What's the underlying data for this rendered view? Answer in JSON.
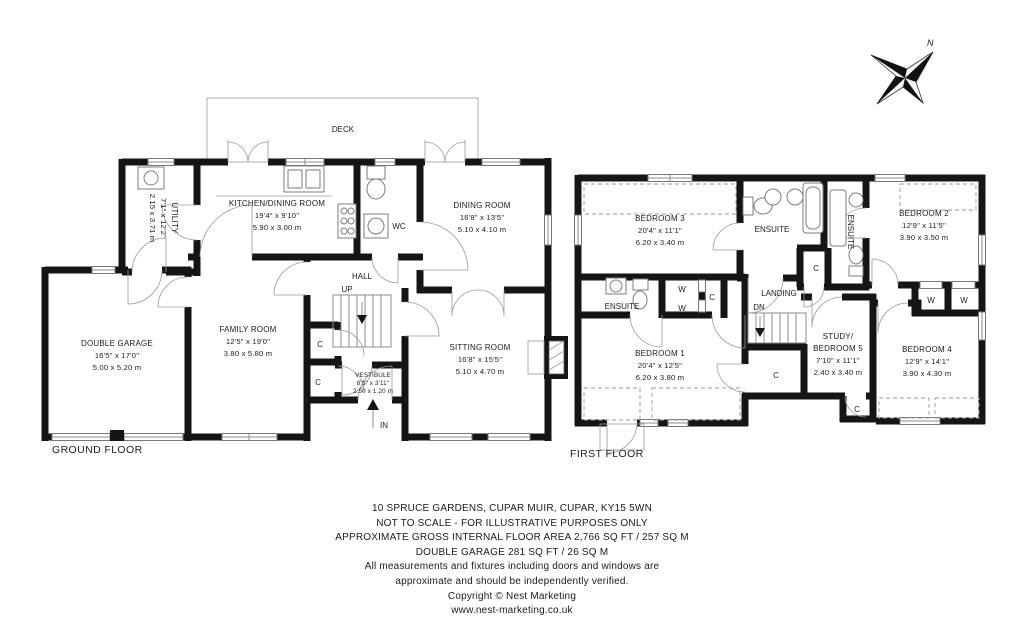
{
  "compass": {
    "north_label": "N"
  },
  "ground_floor": {
    "floor_label": "GROUND FLOOR",
    "deck_label": "DECK",
    "hall_label": "HALL",
    "wc_label": "WC",
    "up_label": "UP",
    "in_label": "IN",
    "closet_labels": [
      "C",
      "C"
    ],
    "rooms": {
      "utility": {
        "name": "UTILITY",
        "dims_ft": "7'1\" x 12'2\"",
        "dims_m": "2.15 x 3.71 m"
      },
      "kitchen_dining": {
        "name": "KITCHEN/DINING ROOM",
        "dims_ft": "19'4\" x 9'10\"",
        "dims_m": "5.90 x 3.00 m"
      },
      "dining": {
        "name": "DINING ROOM",
        "dims_ft": "16'8\" x 13'5\"",
        "dims_m": "5.10 x 4.10 m"
      },
      "double_garage": {
        "name": "DOUBLE GARAGE",
        "dims_ft": "16'5\" x 17'0\"",
        "dims_m": "5.00 x 5.20 m"
      },
      "family": {
        "name": "FAMILY ROOM",
        "dims_ft": "12'5\" x 19'0\"",
        "dims_m": "3.80 x 5.80 m"
      },
      "sitting": {
        "name": "SITTING ROOM",
        "dims_ft": "16'8\" x 15'5\"",
        "dims_m": "5.10 x 4.70 m"
      },
      "vestibule": {
        "name": "VESTIBULE",
        "dims_ft": "8'3\" x 3'11\"",
        "dims_m": "2.50 x 1.20 m"
      }
    }
  },
  "first_floor": {
    "floor_label": "FIRST FLOOR",
    "landing_label": "LANDING",
    "dn_label": "DN",
    "ensuite_labels": [
      "ENSUITE",
      "ENSUITE",
      "ENSUITE"
    ],
    "closet_labels": [
      "C",
      "C",
      "C",
      "C"
    ],
    "wardrobe_labels": [
      "W",
      "W",
      "W",
      "W"
    ],
    "rooms": {
      "bedroom3": {
        "name": "BEDROOM 3",
        "dims_ft": "20'4\" x 11'1\"",
        "dims_m": "6.20 x 3.40 m"
      },
      "bedroom2": {
        "name": "BEDROOM 2",
        "dims_ft": "12'9\" x 11'5\"",
        "dims_m": "3.90 x 3.50 m"
      },
      "bedroom1": {
        "name": "BEDROOM 1",
        "dims_ft": "20'4\" x 12'5\"",
        "dims_m": "6.20 x 3.80 m"
      },
      "bedroom4": {
        "name": "BEDROOM 4",
        "dims_ft": "12'9\" x 14'1\"",
        "dims_m": "3.90 x 4.30 m"
      },
      "study_bedroom5": {
        "name_line1": "STUDY/",
        "name_line2": "BEDROOM 5",
        "dims_ft": "7'10\" x 11'1\"",
        "dims_m": "2.40 x 3.40 m"
      }
    }
  },
  "footer": {
    "lines": [
      "10 SPRUCE GARDENS, CUPAR MUIR, CUPAR, KY15 5WN",
      "NOT TO SCALE - FOR ILLUSTRATIVE PURPOSES ONLY",
      "APPROXIMATE GROSS INTERNAL FLOOR AREA 2,766 SQ FT / 257 SQ M",
      "DOUBLE GARAGE 281 SQ FT / 26 SQ M",
      "All measurements and fixtures including doors and windows are",
      "approximate and should be independently verified.",
      "Copyright © Nest Marketing",
      "www.nest-marketing.co.uk"
    ]
  }
}
